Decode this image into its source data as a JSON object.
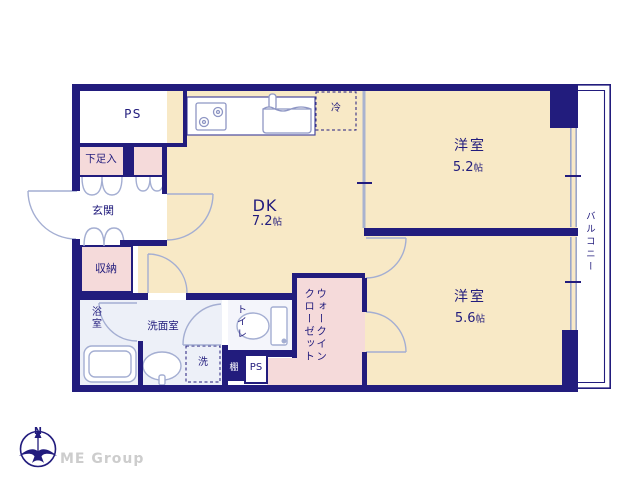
{
  "plan": {
    "rooms": {
      "dk": {
        "name": "DK",
        "size": "7.2",
        "unit": "帖"
      },
      "bedroom1": {
        "name": "洋室",
        "size": "5.2",
        "unit": "帖"
      },
      "bedroom2": {
        "name": "洋室",
        "size": "5.6",
        "unit": "帖"
      },
      "entrance": {
        "label": "玄関"
      },
      "shoe_box": {
        "label": "下足入"
      },
      "storage": {
        "label": "収納"
      },
      "bathroom": {
        "label": "浴室"
      },
      "washroom": {
        "label": "洗面室"
      },
      "toilet": {
        "label": "トイレ"
      },
      "walk_in_closet": {
        "line1": "ウォークイン",
        "line2": "クローゼット"
      },
      "balcony": {
        "label": "バルコニー"
      },
      "pipe_space_top": {
        "label": "PS"
      },
      "pipe_space_bottom": {
        "label": "PS"
      },
      "shelf": {
        "label": "棚"
      },
      "washer": {
        "label": "洗"
      },
      "fridge": {
        "label": "冷"
      }
    },
    "compass": {
      "north_label": "N"
    },
    "branding": {
      "logo_text": "ME Group"
    },
    "colors": {
      "wall_navy": "#221c7d",
      "room_cream": "#f8e9c6",
      "closet_pink": "#f5dada",
      "wet_area_blue": "#edf0f8",
      "fixture_line": "#a4aed2",
      "partition_gray": "#a9b2cf",
      "logo_gray": "#cdcdcd"
    }
  }
}
